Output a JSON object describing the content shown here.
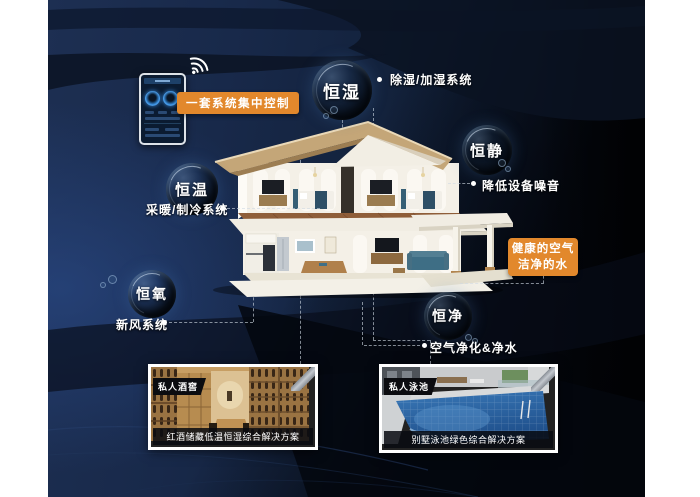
{
  "controller": {
    "label": "一套系统集中控制",
    "icons": {
      "wifi": "wifi-icon",
      "phone": "smart-home-controller-phone"
    }
  },
  "bubbles": {
    "humidity": {
      "label": "恒湿",
      "desc": "除湿/加湿系统"
    },
    "quiet": {
      "label": "恒静",
      "desc": "降低设备噪音"
    },
    "temperature": {
      "label": "恒温",
      "desc": "采暖/制冷系统"
    },
    "oxygen": {
      "label": "恒氧",
      "desc": "新风系统"
    },
    "purity": {
      "label": "恒净",
      "desc": "空气净化&净水"
    }
  },
  "highlight_box": {
    "line1": "健康的空气",
    "line2": "洁净的水"
  },
  "thumbnails": {
    "wine_cellar": {
      "tag": "私人酒窖",
      "caption": "红酒储藏低温恒湿综合解决方案"
    },
    "pool": {
      "tag": "私人泳池",
      "caption": "别墅泳池绿色综合解决方案"
    }
  },
  "colors": {
    "accent_orange": "#e2882c",
    "background_navy": "#18294a",
    "deep_black": "#04070d",
    "label_text": "#ffffff",
    "pool_blue": "#2f6cab",
    "wood_tan": "#c79e63"
  }
}
